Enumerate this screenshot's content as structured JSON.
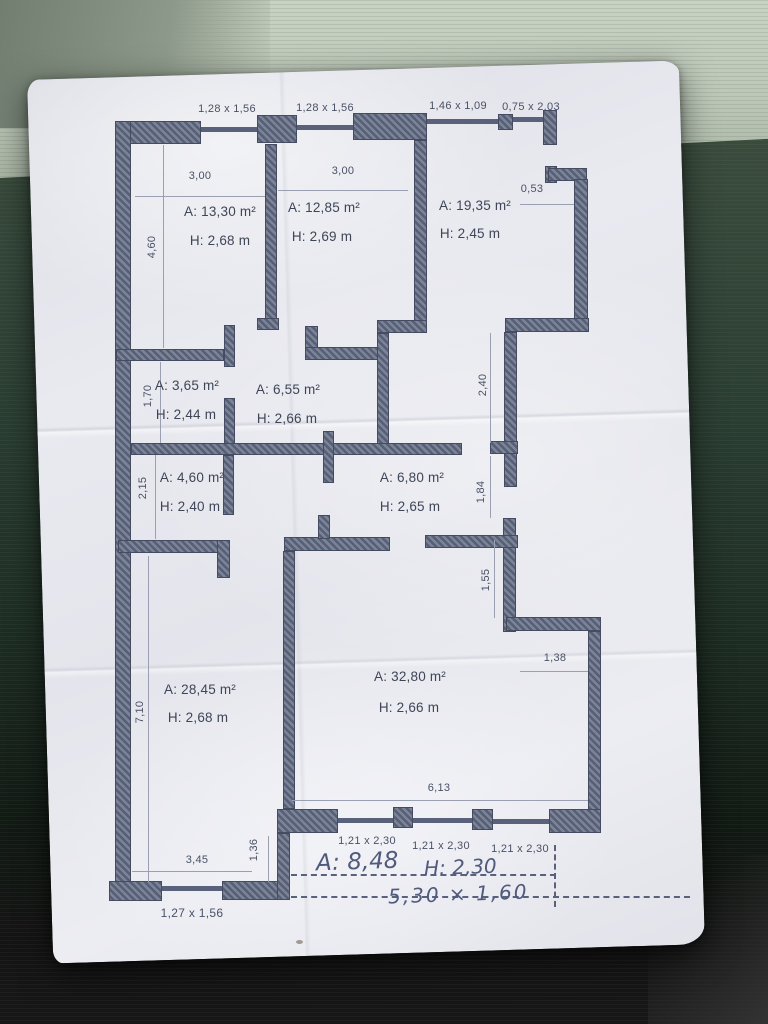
{
  "photo": {
    "colors": {
      "table_top_light": "#bdc7b8",
      "table_green": "#2a3d31",
      "table_bottom_dark": "#141414",
      "paper": "#e9eaf0",
      "wall_hatch_light": "#7b8399",
      "wall_hatch_dark": "#575f75",
      "plan_ink": "#3e4557",
      "dim_ink": "#4a5166",
      "handwriting_ink": "#4f5a7c"
    }
  },
  "plan": {
    "top_openings": [
      {
        "label": "1,28 x 1,56"
      },
      {
        "label": "1,28 x 1,56"
      },
      {
        "label": "1,46 x 1,09"
      },
      {
        "label": "0,75 x 2,03"
      }
    ],
    "rooms": [
      {
        "area": "A: 13,30 m²",
        "height": "H: 2,68 m"
      },
      {
        "area": "A: 12,85 m²",
        "height": "H: 2,69 m"
      },
      {
        "area": "A: 19,35 m²",
        "height": "H: 2,45 m"
      },
      {
        "area": "A: 3,65 m²",
        "height": "H: 2,44 m"
      },
      {
        "area": "A: 6,55 m²",
        "height": "H: 2,66 m"
      },
      {
        "area": "A: 4,60 m²",
        "height": "H: 2,40 m"
      },
      {
        "area": "A: 6,80 m²",
        "height": "H: 2,65 m"
      },
      {
        "area": "A: 28,45 m²",
        "height": "H: 2,68 m"
      },
      {
        "area": "A: 32,80 m²",
        "height": "H: 2,66 m"
      }
    ],
    "dims": {
      "w_room1": "3,00",
      "w_room2": "3,00",
      "niche": "0,53",
      "v460": "4,60",
      "v170": "1,70",
      "v215": "2,15",
      "v710": "7,10",
      "v240": "2,40",
      "v184": "1,84",
      "v155": "1,55",
      "w138": "1,38",
      "w613": "6,13",
      "w345": "3,45",
      "v136": "1,36"
    },
    "bottom_openings": [
      {
        "label": "1,21 x 2,30"
      },
      {
        "label": "1,21 x 2,30"
      },
      {
        "label": "1,21 x 2,30"
      }
    ],
    "bottom_window": {
      "label": "1,27 x 1,56"
    },
    "handwritten": {
      "area": "A: 8,48",
      "height": "H: 2,30",
      "size": "5,30 × 1,60"
    }
  }
}
